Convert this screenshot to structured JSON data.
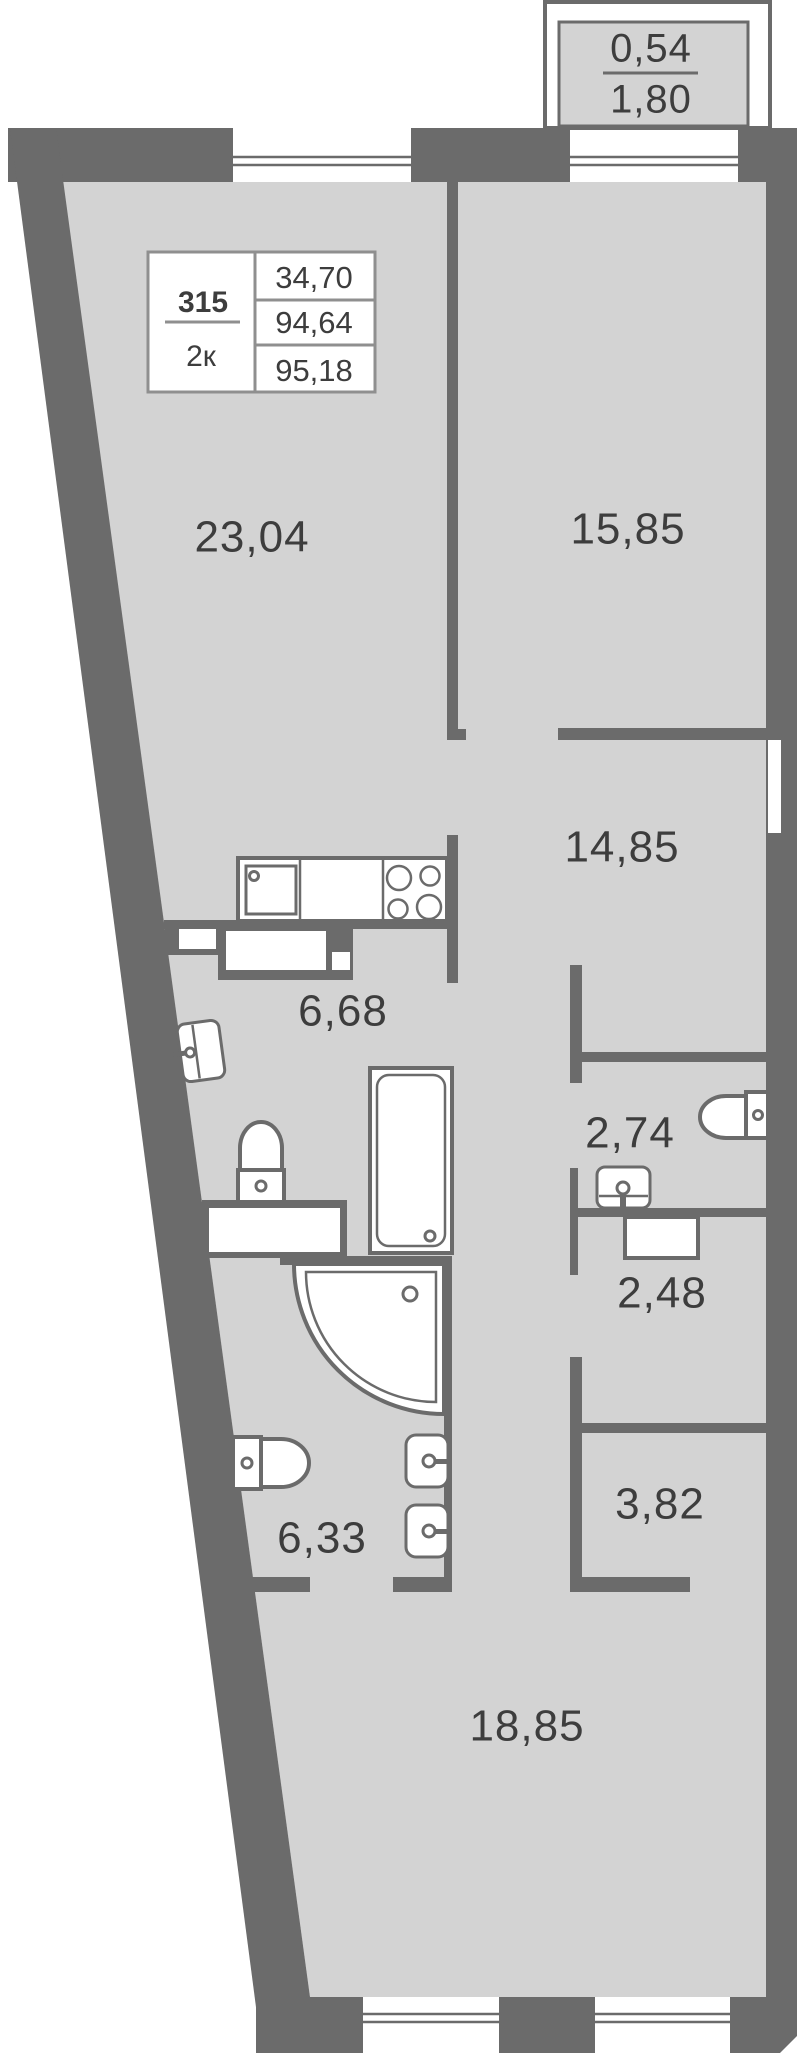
{
  "title": "Apartment floor plan",
  "colors": {
    "wall": "#6b6b6b",
    "floor": "#d3d3d3",
    "text": "#3d3d3d",
    "box_border": "#8f8f8f"
  },
  "balcony": {
    "upper": "0,54",
    "lower": "1,80"
  },
  "unit_info": {
    "number": "315",
    "type": "2к",
    "values": [
      "34,70",
      "94,64",
      "95,18"
    ]
  },
  "rooms": {
    "living": "23,04",
    "bedroom": "15,85",
    "hallway": "14,85",
    "kitchen": "6,68",
    "wc": "2,74",
    "bathroom_small": "2,48",
    "wardrobe": "3,82",
    "bathroom": "6,33",
    "corridor": "18,85"
  }
}
